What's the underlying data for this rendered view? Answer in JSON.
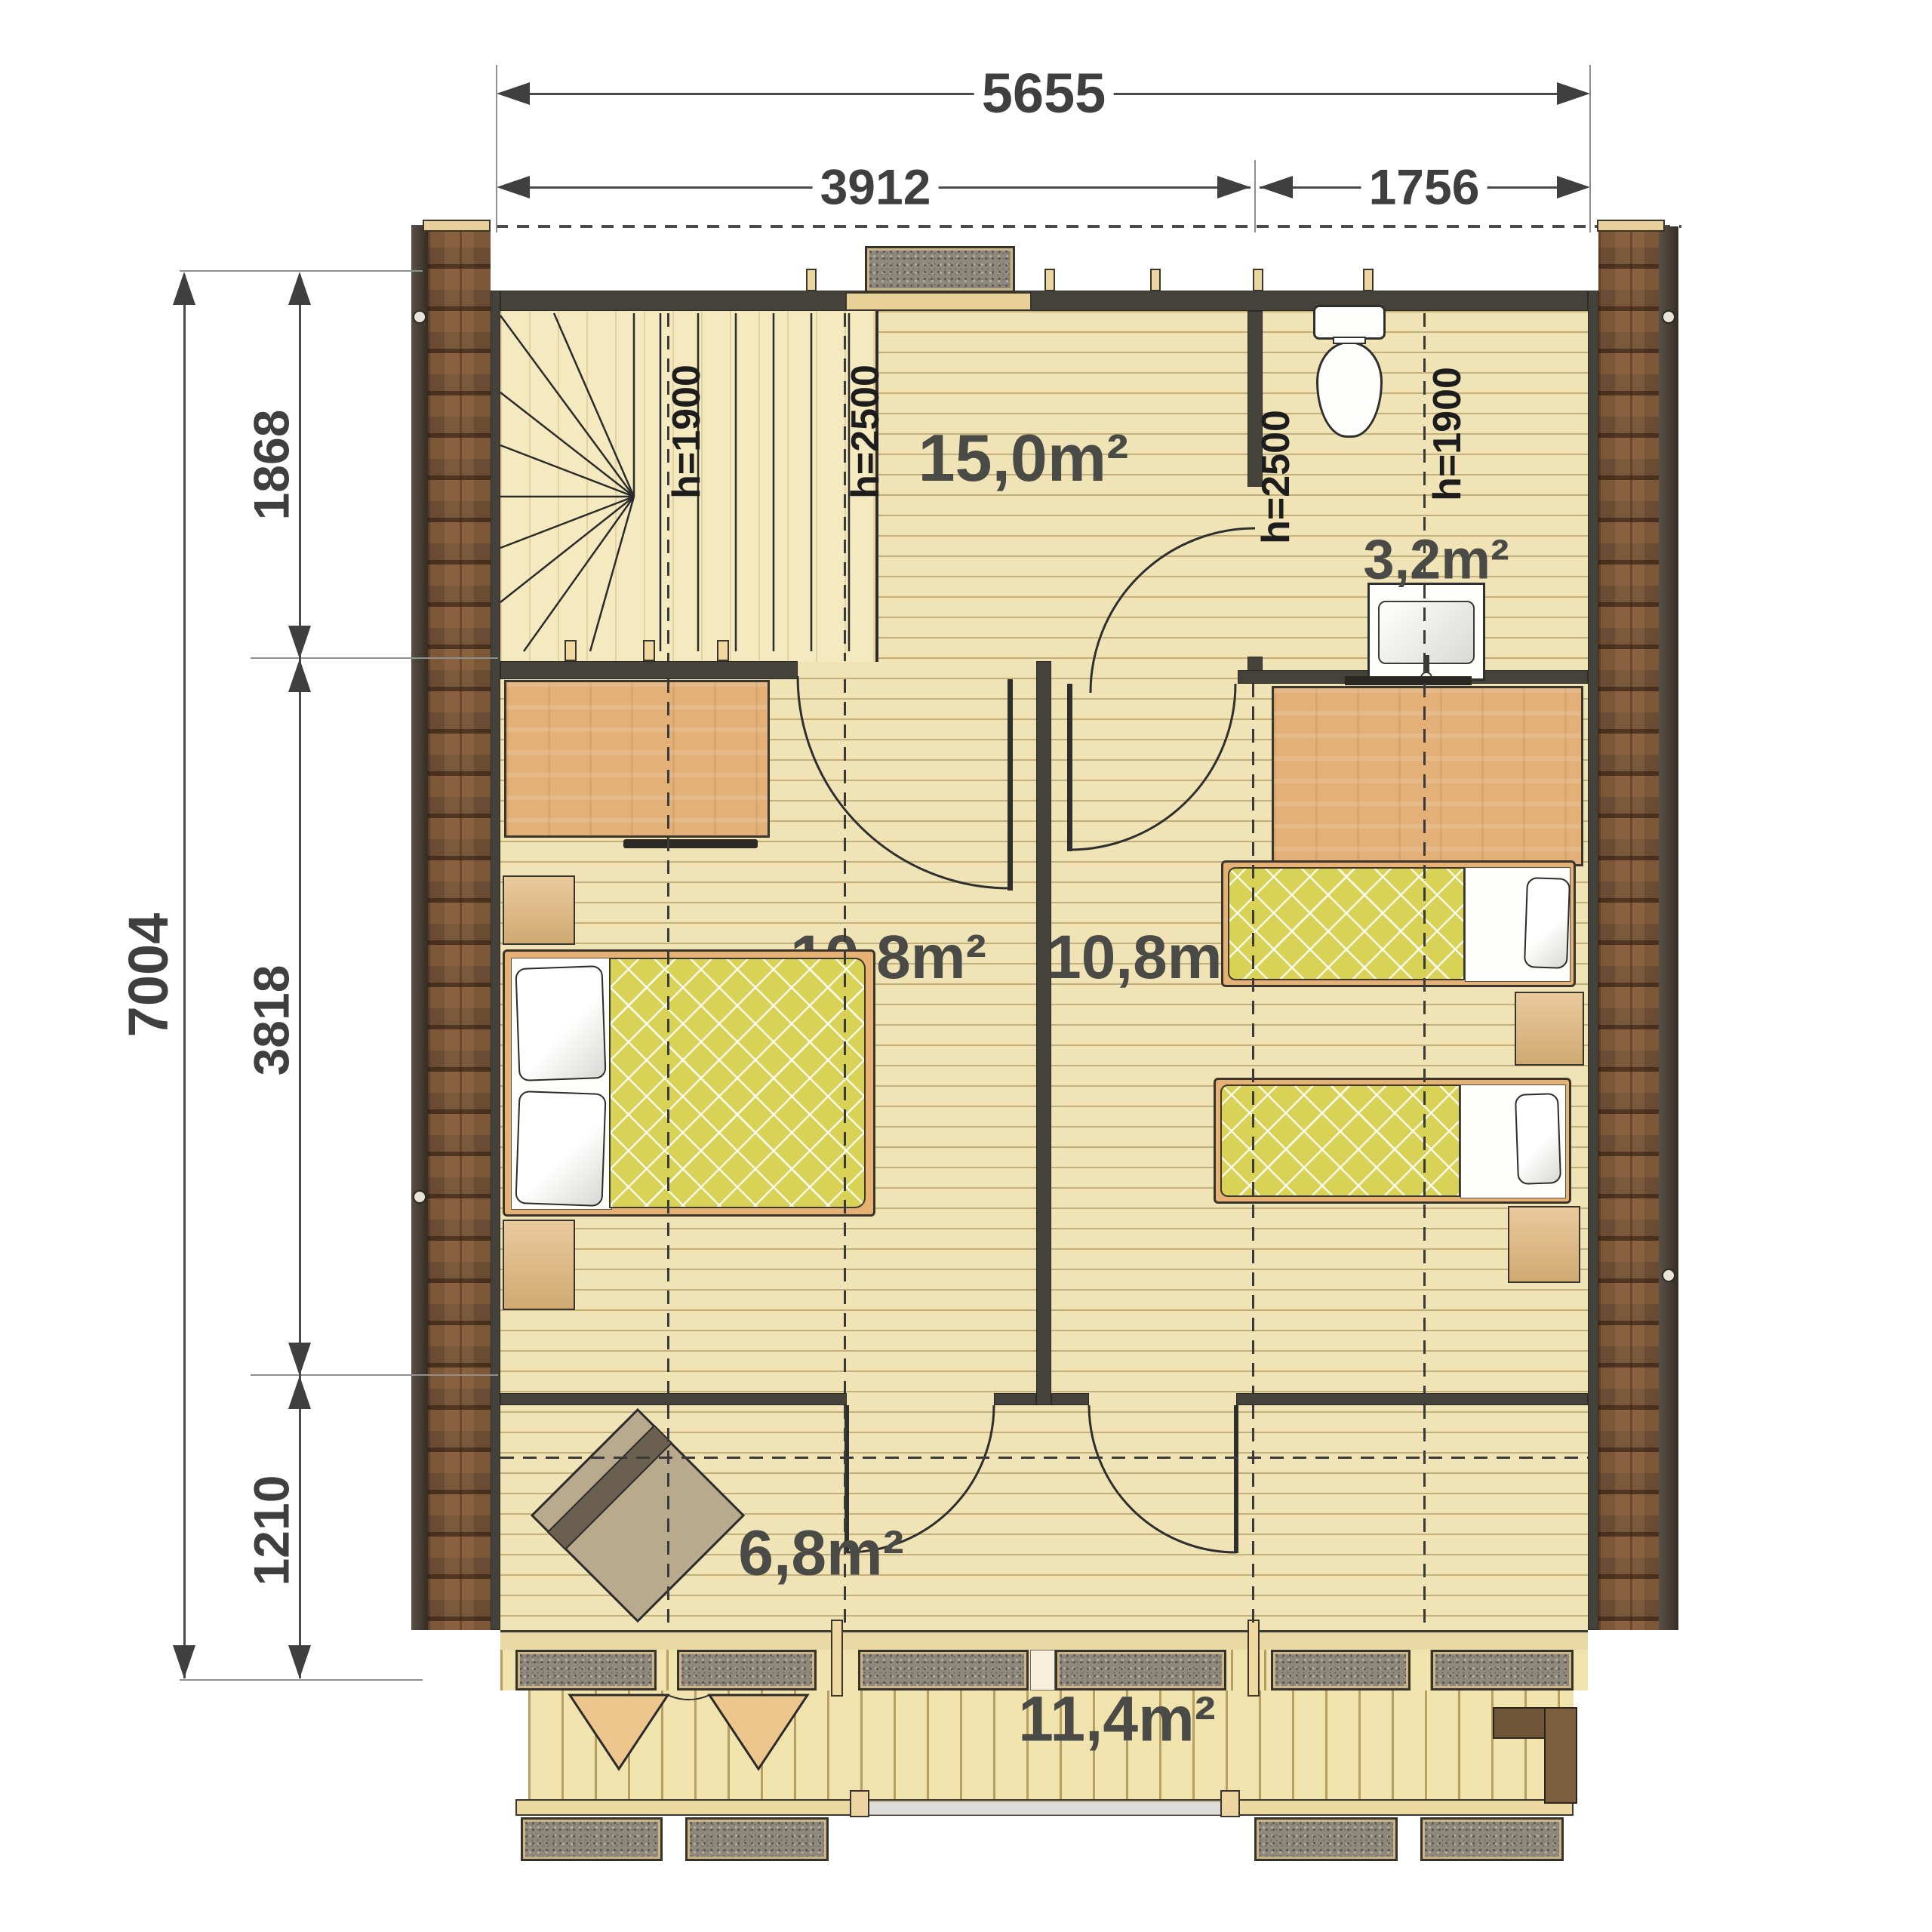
{
  "title": "Upper floor plan with dimensions",
  "dimensions": {
    "top_overall": "5655",
    "top_left": "3912",
    "top_right": "1756",
    "side_overall": "7004",
    "side_upper": "1868",
    "side_middle": "3818",
    "side_lower": "1210"
  },
  "rooms": {
    "loft": "15,0m²",
    "bathroom": "3,2m²",
    "bedroom_left": "10,8m²",
    "bedroom_right": "10,8m²",
    "hallway": "6,8m²",
    "terrace": "11,4m²"
  },
  "heights": {
    "h1900_left": "h=1900",
    "h2500_left": "h=2500",
    "h2500_right": "h=2500",
    "h1900_right": "h=1900"
  },
  "icons": [
    "toilet-icon",
    "sink-icon",
    "double-bed-icon",
    "single-bed-icon",
    "armchair-icon",
    "staircase-icon",
    "wardrobe-icon",
    "window-icon",
    "door-swing-icon"
  ],
  "colors": {
    "dim_text": "#3f3f3f",
    "wall": "#45423c",
    "floor": "#f0e4b6",
    "deck": "#f1e3ae",
    "shingle": "#93704c",
    "mattress": "#d8d257",
    "wardrobe": "#e3b077",
    "window_fill": "#8f887d"
  }
}
